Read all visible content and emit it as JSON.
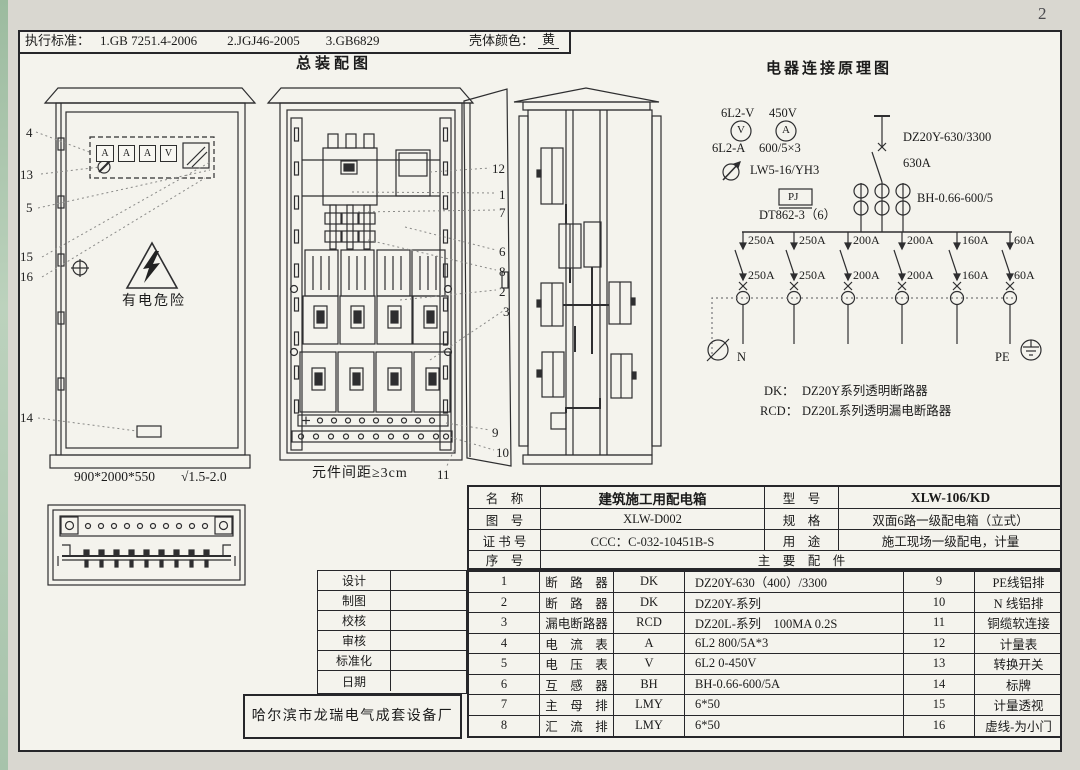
{
  "page": {
    "number": "2"
  },
  "top_bar": {
    "standards_label": "执行标准：",
    "standard_1": "1.GB 7251.4-2006",
    "standard_2": "2.JGJ46-2005",
    "standard_3": "3.GB6829",
    "shell_color_label": "壳体颜色：",
    "shell_color_value": "黄"
  },
  "assembly": {
    "title": "总装配图",
    "dimensions": "900*2000*550",
    "surface_finish": "√1.5-2.0",
    "warning": "有电危险",
    "spacing_note": "元件间距≥3cm",
    "meter_windows": [
      "A",
      "A",
      "A",
      "V"
    ],
    "front_callouts": [
      "4",
      "13",
      "5",
      "15",
      "16",
      "14"
    ],
    "internal_callouts": [
      "12",
      "1",
      "7",
      "6",
      "8",
      "2",
      "3",
      "9",
      "10",
      "11"
    ]
  },
  "schematic": {
    "title": "电器连接原理图",
    "voltmeter_model": "6L2-V",
    "voltmeter_letter": "V",
    "voltage_rating": "450V",
    "ammeter_letter": "A",
    "ammeter_model": "6L2-A",
    "ct_ratio": "600/5×3",
    "changeover_switch": "LW5-16/YH3",
    "meter_box": "PJ",
    "energy_meter": "DT862-3（6）",
    "main_breaker_model": "DZ20Y-630/3300",
    "main_breaker_rating": "630A",
    "ct_model": "BH-0.66-600/5",
    "branch_row1": [
      "250A",
      "250A",
      "200A",
      "200A",
      "160A",
      "60A"
    ],
    "branch_row2": [
      "250A",
      "250A",
      "200A",
      "200A",
      "160A",
      "60A"
    ],
    "neutral": "N",
    "earth": "PE",
    "legend_dk_key": "DK：",
    "legend_dk_value": "DZ20Y系列透明断路器",
    "legend_rcd_key": "RCD：",
    "legend_rcd_value": "DZ20L系列透明漏电断路器"
  },
  "title_block": {
    "name_label": "名　称",
    "name_value": "建筑施工用配电箱",
    "model_label": "型　号",
    "model_value": "XLW-106/KD",
    "drawing_no_label": "图　号",
    "drawing_no_value": "XLW-D002",
    "spec_label": "规　格",
    "spec_value": "双面6路一级配电箱（立式）",
    "cert_label": "证 书 号",
    "cert_value": "CCC：C-032-10451B-S",
    "use_label": "用　途",
    "use_value": "施工现场一级配电，计量",
    "serial_label": "序　号",
    "main_parts_label": "主　要　配　件"
  },
  "parts": {
    "rows": [
      {
        "no": "1",
        "name": "断　路　器",
        "code": "DK",
        "spec": "DZ20Y-630（400）/3300",
        "no2": "9",
        "name2": "PE线铝排"
      },
      {
        "no": "2",
        "name": "断　路　器",
        "code": "DK",
        "spec": "DZ20Y-系列",
        "no2": "10",
        "name2": "N 线铝排"
      },
      {
        "no": "3",
        "name": "漏电断路器",
        "code": "RCD",
        "spec": "DZ20L-系列　100MA 0.2S",
        "no2": "11",
        "name2": "铜缆软连接"
      },
      {
        "no": "4",
        "name": "电　流　表",
        "code": "A",
        "spec": "6L2 800/5A*3",
        "no2": "12",
        "name2": "计量表"
      },
      {
        "no": "5",
        "name": "电　压　表",
        "code": "V",
        "spec": "6L2 0-450V",
        "no2": "13",
        "name2": "转换开关"
      },
      {
        "no": "6",
        "name": "互　感　器",
        "code": "BH",
        "spec": "BH-0.66-600/5A",
        "no2": "14",
        "name2": "标牌"
      },
      {
        "no": "7",
        "name": "主　母　排",
        "code": "LMY",
        "spec": "6*50",
        "no2": "15",
        "name2": "计量透视"
      },
      {
        "no": "8",
        "name": "汇　流　排",
        "code": "LMY",
        "spec": "6*50",
        "no2": "16",
        "name2": "虚线-为小门"
      }
    ]
  },
  "sign_block": {
    "labels": [
      "设计",
      "制图",
      "校核",
      "审核",
      "标准化",
      "日期"
    ],
    "company": "哈尔滨市龙瑞电气成套设备厂"
  }
}
